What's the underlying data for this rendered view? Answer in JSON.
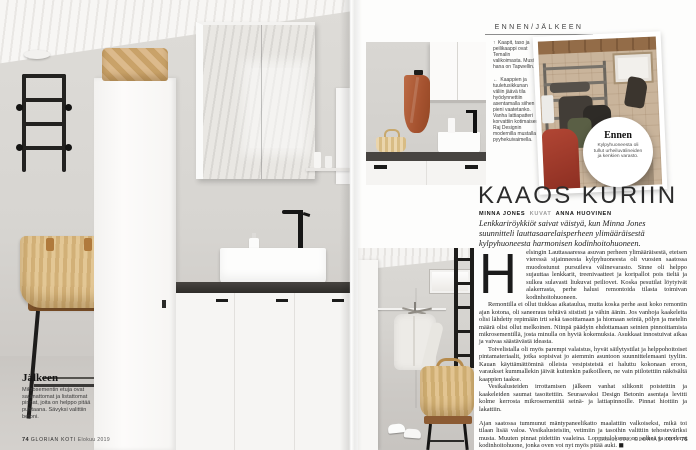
{
  "header": {
    "label": "ENNEN/JÄLKEEN"
  },
  "left_page": {
    "caption_title": "Jälkeen",
    "caption_text": "Mikrosementin etuja ovat saumattomat ja listattomat pinnat, joita on helppo pitää puhtaana. Sävyksi valittiin betoni.",
    "folio": {
      "page": "74",
      "magazine": "GLORIAN KOTI",
      "issue": "Elokuu 2019"
    }
  },
  "right_page": {
    "captions": [
      {
        "arrow": "↑",
        "text": "Kaapit, taso ja peilikaappi ovat Temalin valikoimasta. Musta hana on Tapwellin."
      },
      {
        "arrow": "←",
        "text": "Kaappien ja tuuletusikkunan väliin jäävä tila hyödynnettiin asentamalla siihen pieni vaatetanko. Vanha lattiapatteri korvattiin kotimaisen Raj Designin modernilla mustalla pyyhekuivaimella."
      }
    ],
    "badge": {
      "title": "Ennen",
      "text": "Kylpyhuoneesta oli tullut urheiluvälineiden ja kenkien varasto."
    },
    "folio": {
      "issue": "Elokuu 2019",
      "magazine": "GLORIAN KOTI",
      "page": "75"
    }
  },
  "article": {
    "title": "KAAOS KURIIN",
    "byline": {
      "author": "MINNA JONES",
      "credit_label": "KUVAT",
      "photographer": "ANNA HUOVINEN"
    },
    "lead": "Lenkkariröykkiöt saivat väistyä, kun Minna Jones suunnitteli lauttasaarelaisperheen ylimääräisestä kylpyhuoneesta harmonisen kodinhoitohuoneen.",
    "dropcap": "H",
    "paragraphs": [
      "elsingin Lauttasaaressa asuvan perheen ylimääräisestä, eteisen vieressä sijainneesta kylpyhuoneesta oli vuosien saatossa muodostunut pursuileva välinevarasto. Sinne oli helppo sujauttaa lenkkarit, treenivaatteet ja koripallot pois tieltä ja sulkea sulavasti liukuvat peiliovet. Koska pesutilat löytyivät alakerrasta, perhe halusi remontoida tilasta toimivan kodinhoitohuoneen.",
      "Remontilla ei ollut tiukkaa aikataulua, mutta koska perhe asui koko remontin ajan kotona, oli saneeraus tehtävä siististi ja vähin äänin. Jos vanhoja kaakeleita olisi lähdetty repimään irti sekä tasoittamaan ja hiomaan seiniä, pölyn ja metelin määrä olisi ollut melkoinen. Niinpä päädyin ehdottamaan seinien pinnoittamista mikrosementillä, josta minulla on hyviä kokemuksia. Asukkaat innostuivat aikaa ja vaivaa säästävästä ideasta.",
      "Toivelistalla oli myös parempi valaistus, hyvät säilytystilat ja helppohoitoiset pintamateriaalit, jotka sopisivat jo aiemmin asuntoon suunnittelemaani tyyliin. Kauan käyttämättöminä olleista vesipisteistä ei haluttu kokonaan eroon, varaukset kummallekin jäivät kuitenkin paikoilleen, ne vain piilotettiin näkösältä kaappien taakse.",
      "Vesikalusteiden irrottamisen jälkeen vanhat silikonit poistettiin ja kaakeleiden saumat tasoitettiin. Seuraavaksi Design Betonin asentaja levitti kolme kerrosta mikrosementtiä seinä- ja lattiapinnoille. Pinnat hiottiin ja lakattiin.",
      "Ajan saatossa tummunut mäntypaneelikatto maalattiin valkoiseksi, mikä toi tilaan lisää valoa. Vesikalusteisiin, vetimiin ja tasoihin valittiin tehosteväriksi musta. Muuten pinnat pidettiin vaaleina. Lopputuloksena on selkeä ja moderni kodinhoitohuone, jonka oven voi nyt myös pitää auki. ◼"
    ]
  },
  "palette": {
    "towel_rust": "#b2613c",
    "basket_tan": "#d8b88b",
    "fixture_black": "#1d1d1b",
    "wall_gray": "#d6d4d0",
    "counter_dark": "#3a3836"
  }
}
